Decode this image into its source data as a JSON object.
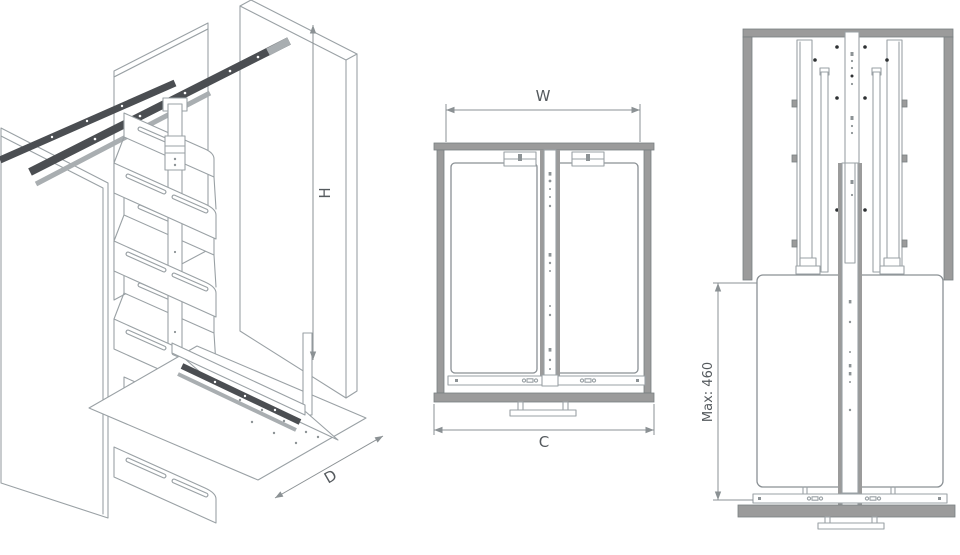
{
  "labels": {
    "H": "H",
    "D": "D",
    "W": "W",
    "C": "C",
    "max": "Max: 460"
  },
  "diagram": {
    "type": "technical-drawing",
    "subject": "pull-out larder unit with baskets",
    "views": [
      {
        "name": "isometric-pullout-larder",
        "dimension_labels": [
          "H",
          "D"
        ]
      },
      {
        "name": "plan-top-view",
        "dimension_labels": [
          "W",
          "C"
        ]
      },
      {
        "name": "front-elevation",
        "dimension_labels": [
          "Max: 460"
        ]
      }
    ]
  },
  "colors": {
    "background": "#ffffff",
    "line": "#9aa1a5",
    "cabinet_gray": "#9b9b9b",
    "rail_dark": "#4b4e52",
    "dimension_text": "#555a5e",
    "hole_dot": "#2e3133"
  }
}
